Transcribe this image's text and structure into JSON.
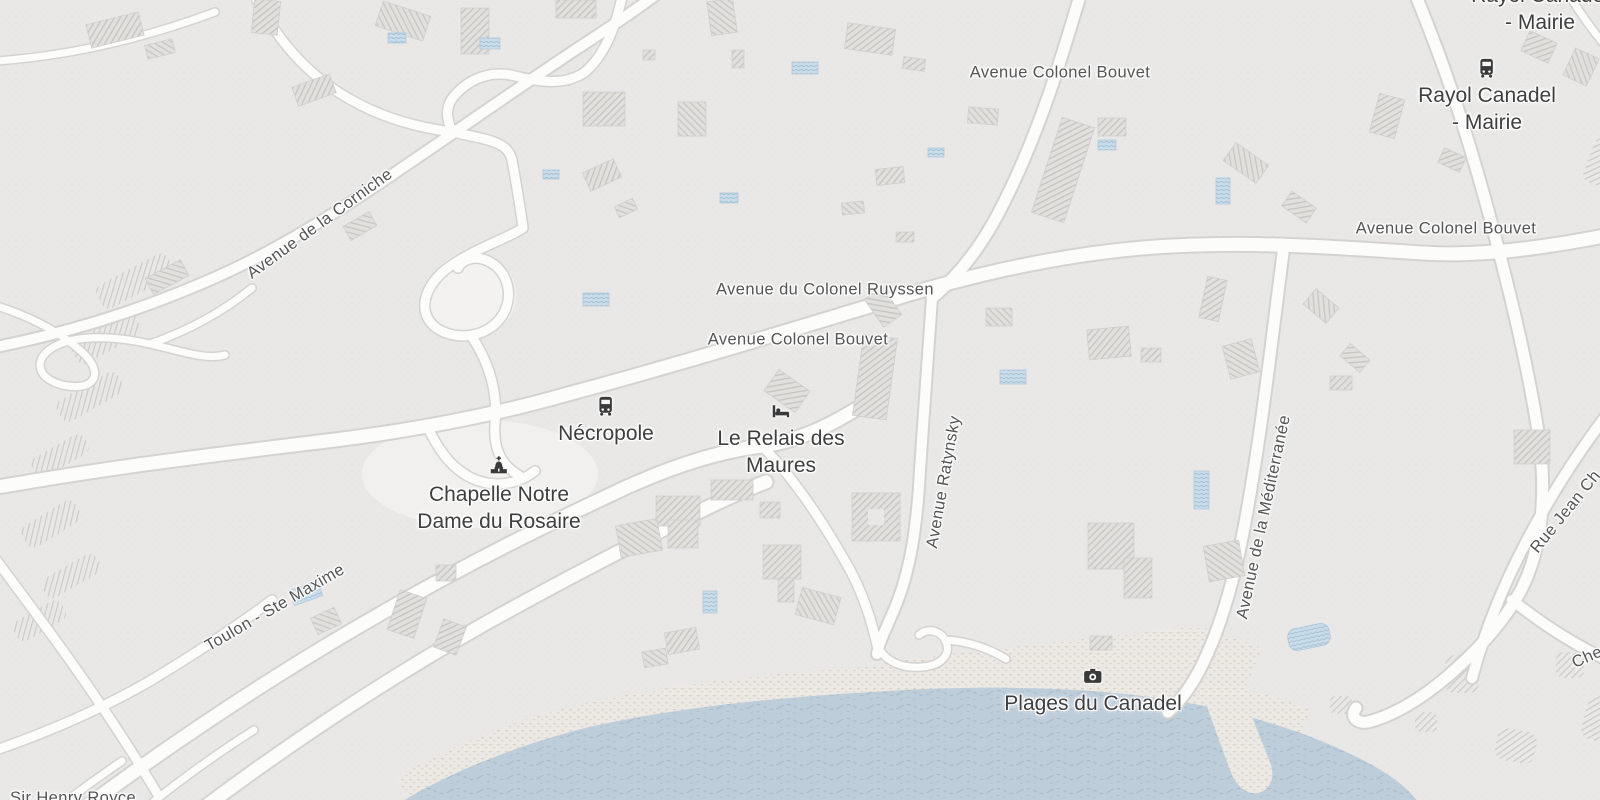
{
  "colors": {
    "land": "#e9e8e6",
    "water": "#becdda",
    "road_fill": "#fcfcfb",
    "road_casing": "#d4d3d1",
    "building_fill": "#e1e0dd",
    "building_hatch": "#c6c5c2",
    "pool_fill": "#cadcea",
    "sand": "#ece9e4",
    "street_label": "#545454",
    "poi_label": "#3e3e3e",
    "icon": "#3a3a3a"
  },
  "street_labels": {
    "bouvet_top": "Avenue Colonel Bouvet",
    "bouvet_right": "Avenue Colonel Bouvet",
    "ruyssen": "Avenue du Colonel Ruyssen",
    "bouvet_center": "Avenue Colonel Bouvet",
    "corniche": "Avenue de la Corniche",
    "ratynsky": "Avenue Ratynsky",
    "mediterranee": "Avenue de la Méditerranée",
    "rue_jean": "Rue Jean Ch",
    "toulon_ste_maxime": "Toulon - Ste Maxime",
    "chemin": "Chemin",
    "sir_henry_royce": "Sir Henry Royce"
  },
  "poi_labels": {
    "rayol_mairie_top": {
      "line1": "Rayol Canadel",
      "line2": "- Mairie"
    },
    "rayol_mairie": {
      "line1": "Rayol Canadel",
      "line2": "- Mairie",
      "icon": "bus-icon"
    },
    "necropole": {
      "line1": "Nécropole",
      "icon": "bus-icon"
    },
    "relais_des_maures": {
      "line1": "Le Relais des",
      "line2": "Maures",
      "icon": "lodging-icon"
    },
    "chapelle": {
      "line1": "Chapelle Notre",
      "line2": "Dame du Rosaire",
      "icon": "chapel-icon"
    },
    "plages_du_canadel": {
      "line1": "Plages du Canadel",
      "icon": "camera-icon"
    }
  }
}
